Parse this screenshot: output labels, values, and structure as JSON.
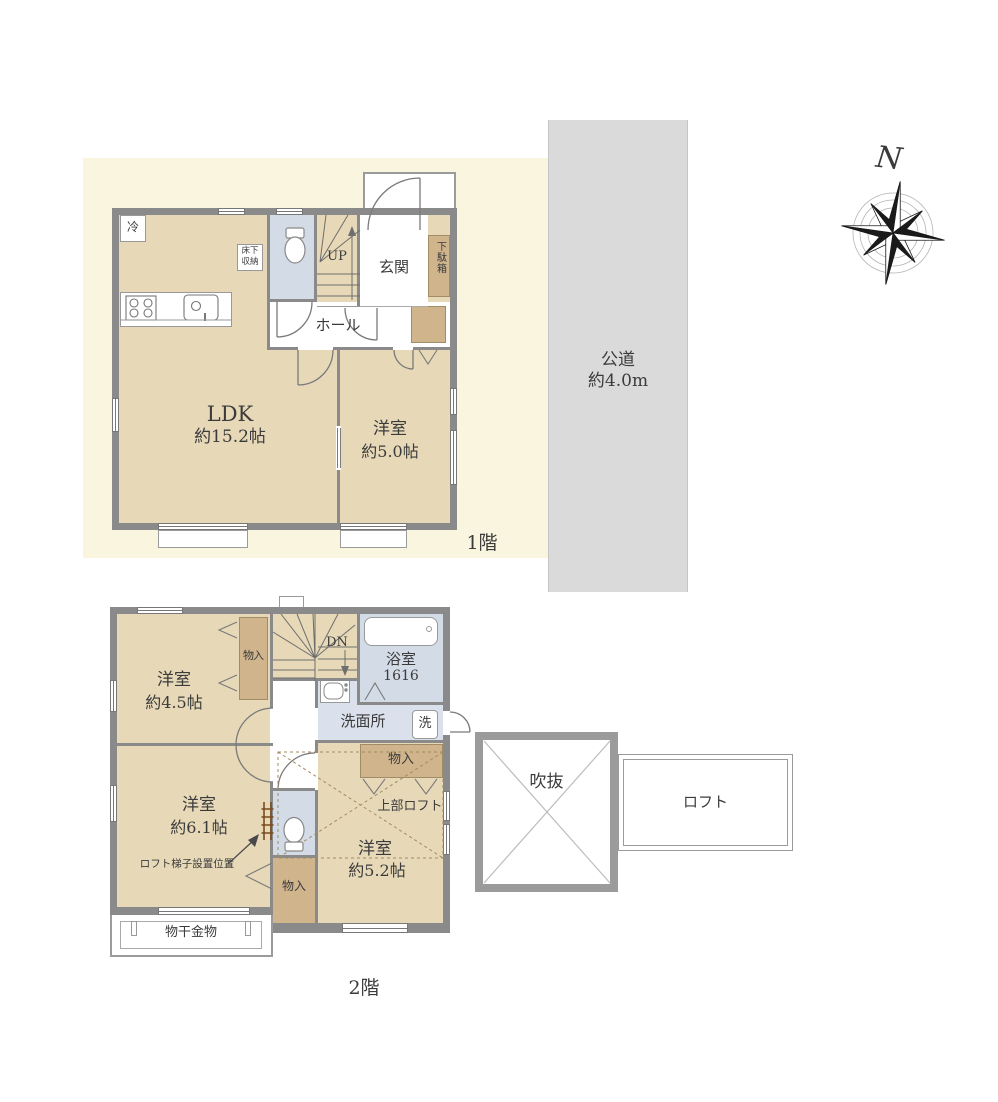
{
  "colors": {
    "wall": "#8a8a8a",
    "light_wall": "#9b9b9b",
    "room_tan": "#e7d9b8",
    "closet_tan": "#cfb48c",
    "wet_blue": "#d3dbe7",
    "cream_bg": "#f9f5df",
    "road_gray": "#d9dad9",
    "text": "#3b3b3b"
  },
  "site": {
    "road_name": "公道",
    "road_width": "約4.0m",
    "compass_north": "N"
  },
  "floor1": {
    "floor_label": "1階",
    "ldk_name": "LDK",
    "ldk_size": "約15.2帖",
    "bedroom_name": "洋室",
    "bedroom_size": "約5.0帖",
    "entrance": "玄関",
    "hall": "ホール",
    "stairs": "UP",
    "refrigerator": "冷",
    "floor_storage_line1": "床下",
    "floor_storage_line2": "収納",
    "shoe_cabinet": "下駄箱"
  },
  "floor2": {
    "floor_label": "2階",
    "bedroom45_name": "洋室",
    "bedroom45_size": "約4.5帖",
    "bedroom61_name": "洋室",
    "bedroom61_size": "約6.1帖",
    "bedroom52_name": "洋室",
    "bedroom52_size": "約5.2帖",
    "bathroom_name": "浴室",
    "bathroom_size": "1616",
    "washroom": "洗面所",
    "washer": "洗",
    "stairs": "DN",
    "closet": "物入",
    "upper_loft": "上部ロフト",
    "ladder_note": "ロフト梯子設置位置",
    "laundry_hardware": "物干金物",
    "void": "吹抜",
    "loft": "ロフト"
  }
}
